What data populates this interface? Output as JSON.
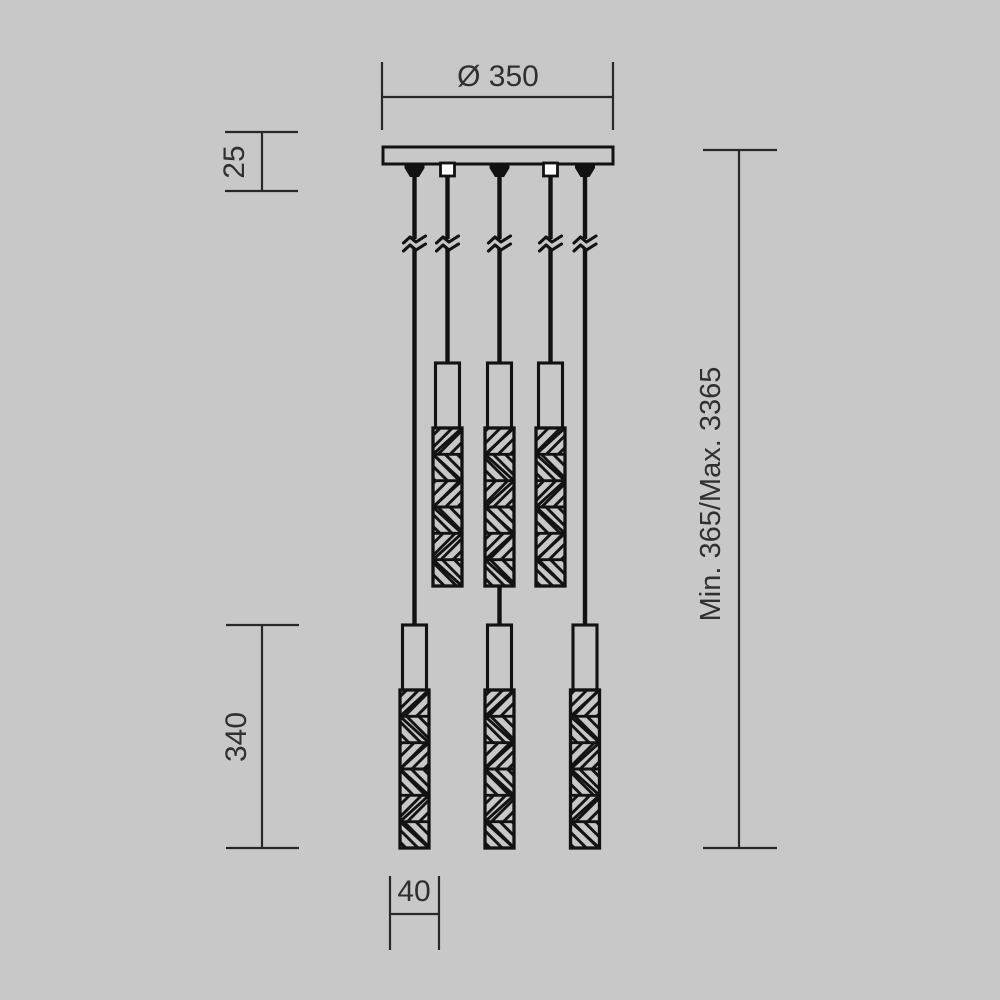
{
  "canvas": {
    "background": "#c8c8c8",
    "line_color": "#121212",
    "dim_line_color": "#282828",
    "text_color": "#303030",
    "open_connector_fill": "#ffffff"
  },
  "fixture": {
    "type": "pendant-light-technical-drawing",
    "cable_count": 5,
    "pendant_count": 6
  },
  "dimensions": {
    "canopy_diameter_label": "Ø 350",
    "canopy_height_label": "25",
    "pendant_length_label": "340",
    "suspension_height_label": "Min. 365/Max. 3365",
    "pendant_diameter_label": "40"
  }
}
